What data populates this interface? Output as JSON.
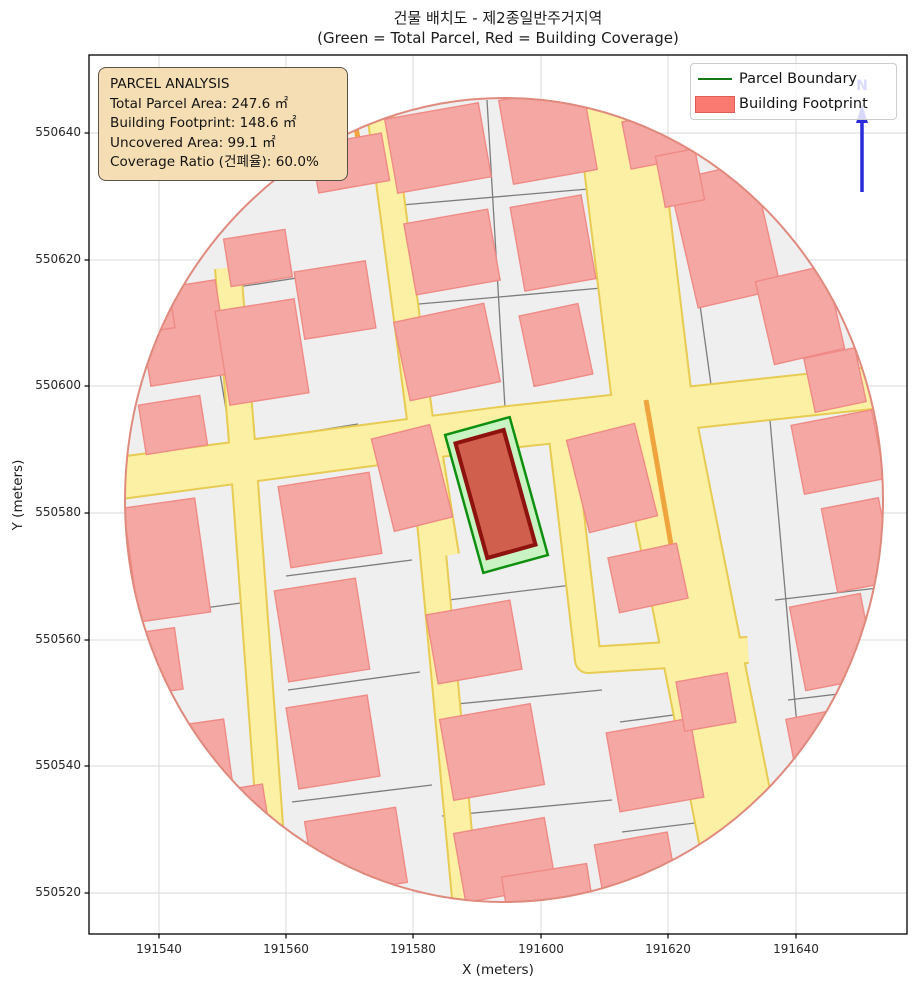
{
  "title": {
    "line1": "건물 배치도 - 제2종일반주거지역",
    "line2": "(Green = Total Parcel, Red = Building Coverage)"
  },
  "axes": {
    "x_label": "X (meters)",
    "y_label": "Y (meters)",
    "x_ticks": [
      {
        "label": "191540",
        "px": 159
      },
      {
        "label": "191560",
        "px": 286
      },
      {
        "label": "191580",
        "px": 413
      },
      {
        "label": "191600",
        "px": 541
      },
      {
        "label": "191620",
        "px": 668
      },
      {
        "label": "191640",
        "px": 796
      }
    ],
    "y_ticks": [
      {
        "label": "550640",
        "py": 133
      },
      {
        "label": "550620",
        "py": 260
      },
      {
        "label": "550600",
        "py": 386
      },
      {
        "label": "550580",
        "py": 513
      },
      {
        "label": "550560",
        "py": 640
      },
      {
        "label": "550540",
        "py": 766
      },
      {
        "label": "550520",
        "py": 893
      }
    ]
  },
  "info_box": {
    "title": "PARCEL ANALYSIS",
    "lines": [
      "Total Parcel Area: 247.6 ㎡",
      "Building Footprint: 148.6 ㎡",
      "Uncovered Area: 99.1 ㎡",
      "Coverage Ratio (건폐율): 60.0%"
    ]
  },
  "legend": {
    "items": [
      {
        "label": "Parcel Boundary",
        "swatch": "line",
        "color": "#157a15"
      },
      {
        "label": "Building Footprint",
        "swatch": "patch",
        "fill": "#fa7a72",
        "edge": "#e05c55"
      }
    ]
  },
  "north_arrow": {
    "label": "N",
    "color": "#2c2cdc"
  },
  "chart_data": {
    "type": "map",
    "title": "건물 배치도 - 제2종일반주거지역",
    "subtitle": "(Green = Total Parcel, Red = Building Coverage)",
    "zone": "제2종일반주거지역",
    "parcel_analysis": {
      "total_parcel_area_m2": 247.6,
      "building_footprint_m2": 148.6,
      "uncovered_area_m2": 99.1,
      "coverage_ratio_pct": 60.0
    },
    "xlabel": "X (meters)",
    "ylabel": "Y (meters)",
    "x_range_m": [
      191529,
      191658
    ],
    "y_range_m": [
      550513,
      550652
    ],
    "legend_entries": [
      "Parcel Boundary",
      "Building Footprint"
    ],
    "legend_position": "upper right",
    "grid": true,
    "map": {
      "plot_rect": {
        "x": 89,
        "y": 55,
        "w": 818,
        "h": 879
      },
      "buffer_ellipse": {
        "cx": 504,
        "cy": 500,
        "rx": 379,
        "ry": 402
      },
      "colors": {
        "base": "#efefef",
        "parcel_line": "#7d7d7d",
        "street_fill": "#fbf0a3",
        "street_edge": "#e7cb52",
        "street_accent": "#f0a43e",
        "building_fill": "#f5a7a4",
        "building_edge": "#ef8a85",
        "rim": "#e0897d",
        "parcel_fill": "#c9f3c3",
        "parcel_edge": "#0f8f0f",
        "target_building_fill": "#d05f4e",
        "target_building_edge": "#8e120e",
        "grid": "#d8d8d8",
        "spine": "#000000"
      },
      "streets": [
        {
          "path": [
            [
              120,
              478
            ],
            [
              500,
              428
            ],
            [
              890,
              386
            ]
          ],
          "w": 40
        },
        {
          "path": [
            [
              614,
              82
            ],
            [
              652,
              400
            ],
            [
              758,
              935
            ]
          ],
          "w": 78
        },
        {
          "path": [
            [
              228,
              268
            ],
            [
              243,
              455
            ],
            [
              278,
              935
            ]
          ],
          "w": 24
        },
        {
          "path": [
            [
              380,
              112
            ],
            [
              422,
              435
            ],
            [
              468,
              930
            ]
          ],
          "w": 24
        },
        {
          "path": [
            [
              430,
              432
            ],
            [
              450,
              555
            ]
          ],
          "w": 16
        },
        {
          "path": [
            [
              558,
              403
            ],
            [
              588,
              660
            ],
            [
              748,
              650
            ]
          ],
          "w": 24
        }
      ],
      "street_accents": [
        [
          646,
          400,
          678,
          585
        ],
        [
          356,
          128,
          364,
          170
        ]
      ],
      "parcel_lines": [
        [
          140,
          302,
          362,
          268
        ],
        [
          146,
          458,
          358,
          424
        ],
        [
          390,
          206,
          600,
          188
        ],
        [
          396,
          306,
          602,
          288
        ],
        [
          208,
          302,
          232,
          445
        ],
        [
          487,
          100,
          505,
          408
        ],
        [
          680,
          160,
          712,
          392
        ],
        [
          745,
          205,
          855,
          190
        ],
        [
          132,
          618,
          248,
          602
        ],
        [
          286,
          576,
          412,
          560
        ],
        [
          288,
          690,
          420,
          672
        ],
        [
          292,
          802,
          432,
          785
        ],
        [
          432,
          602,
          580,
          584
        ],
        [
          436,
          706,
          602,
          690
        ],
        [
          442,
          816,
          612,
          800
        ],
        [
          620,
          722,
          742,
          706
        ],
        [
          622,
          832,
          736,
          818
        ],
        [
          775,
          600,
          878,
          588
        ],
        [
          788,
          700,
          872,
          690
        ],
        [
          770,
          420,
          815,
          930
        ]
      ],
      "buildings": [
        [
          183,
          333,
          80,
          95,
          -9
        ],
        [
          173,
          425,
          62,
          50,
          -9
        ],
        [
          262,
          352,
          80,
          95,
          -9
        ],
        [
          335,
          300,
          72,
          68,
          -9
        ],
        [
          258,
          258,
          62,
          48,
          -9
        ],
        [
          350,
          163,
          72,
          48,
          -10
        ],
        [
          438,
          148,
          95,
          75,
          -10
        ],
        [
          548,
          135,
          85,
          85,
          -10
        ],
        [
          452,
          252,
          85,
          72,
          -10
        ],
        [
          553,
          243,
          72,
          85,
          -10
        ],
        [
          447,
          352,
          92,
          80,
          -12
        ],
        [
          556,
          345,
          60,
          72,
          -12
        ],
        [
          725,
          235,
          85,
          130,
          -13
        ],
        [
          800,
          315,
          72,
          85,
          -13
        ],
        [
          835,
          380,
          52,
          55,
          -12
        ],
        [
          655,
          140,
          58,
          48,
          -11
        ],
        [
          680,
          178,
          40,
          52,
          -11
        ],
        [
          838,
          452,
          82,
          70,
          -11
        ],
        [
          858,
          545,
          58,
          85,
          -11
        ],
        [
          167,
          560,
          72,
          115,
          -8
        ],
        [
          153,
          662,
          52,
          62,
          -8
        ],
        [
          205,
          752,
          46,
          60,
          -8
        ],
        [
          330,
          520,
          92,
          82,
          -9
        ],
        [
          322,
          630,
          82,
          92,
          -9
        ],
        [
          333,
          742,
          82,
          82,
          -9
        ],
        [
          356,
          852,
          92,
          76,
          -9
        ],
        [
          412,
          478,
          60,
          95,
          -14
        ],
        [
          612,
          478,
          70,
          95,
          -14
        ],
        [
          648,
          578,
          70,
          56,
          -12
        ],
        [
          474,
          642,
          85,
          70,
          -10
        ],
        [
          492,
          752,
          92,
          82,
          -10
        ],
        [
          505,
          860,
          92,
          70,
          -10
        ],
        [
          655,
          765,
          85,
          80,
          -10
        ],
        [
          636,
          868,
          74,
          60,
          -10
        ],
        [
          706,
          702,
          52,
          50,
          -10
        ],
        [
          833,
          642,
          72,
          85,
          -11
        ],
        [
          822,
          748,
          60,
          70,
          -11
        ],
        [
          548,
          895,
          86,
          50,
          -9
        ],
        [
          243,
          815,
          48,
          55,
          -9
        ],
        [
          152,
          310,
          40,
          42,
          -9
        ]
      ],
      "target_parcel": {
        "cx": 496.5,
        "cy": 495,
        "w": 67,
        "h": 143,
        "angle": -15.5
      },
      "target_building": {
        "cx": 495.5,
        "cy": 494,
        "w": 50,
        "h": 119,
        "angle": -15.5
      },
      "north_arrow": {
        "x": 862,
        "y_top": 104,
        "y_bottom": 192,
        "label_y": 90
      }
    }
  }
}
